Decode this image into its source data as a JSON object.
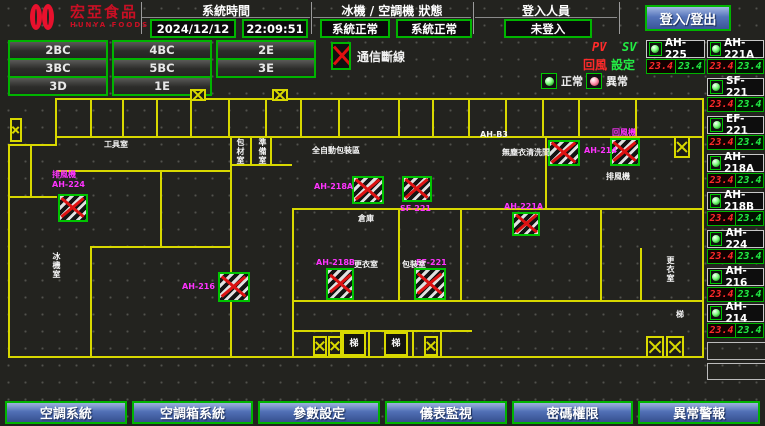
{
  "header": {
    "logo": {
      "line1": "宏亞食品",
      "line2": "HUNYA FOODS"
    },
    "system_time": {
      "label": "系統時間",
      "date": "2024/12/12",
      "time": "22:09:51"
    },
    "machine_status": {
      "label": "冰機 / 空調機 狀態",
      "chiller_status": "系統正常",
      "ahu_status": "系統正常"
    },
    "login": {
      "label": "登入人員",
      "value": "未登入",
      "button": "登入/登出"
    }
  },
  "floor_buttons": [
    {
      "label": "2BC",
      "x": 8,
      "y": 40
    },
    {
      "label": "4BC",
      "x": 112,
      "y": 40
    },
    {
      "label": "2E",
      "x": 216,
      "y": 40
    },
    {
      "label": "3BC",
      "x": 8,
      "y": 58
    },
    {
      "label": "5BC",
      "x": 112,
      "y": 58
    },
    {
      "label": "3E",
      "x": 216,
      "y": 58
    },
    {
      "label": "3D",
      "x": 8,
      "y": 76
    },
    {
      "label": "1E",
      "x": 112,
      "y": 76
    }
  ],
  "legend": {
    "comm_loss": "通信斷線",
    "normal": "正常",
    "abnormal": "異常",
    "pv": "PV",
    "sv": "SV",
    "pv_name": "回風",
    "sv_name": "設定"
  },
  "sidebar": {
    "units": [
      {
        "name": "AH-225",
        "pv": "23.4",
        "sv": "23.4",
        "x": 646,
        "y": 40,
        "w": 59
      },
      {
        "name": "AH-221A",
        "pv": "23.4",
        "sv": "23.4",
        "x": 707,
        "y": 40,
        "w": 57
      },
      {
        "name": "SF-221",
        "pv": "23.4",
        "sv": "23.4",
        "x": 707,
        "y": 78,
        "w": 57
      },
      {
        "name": "EF-221",
        "pv": "23.4",
        "sv": "23.4",
        "x": 707,
        "y": 116,
        "w": 57
      },
      {
        "name": "AH-218A",
        "pv": "23.4",
        "sv": "23.4",
        "x": 707,
        "y": 154,
        "w": 57
      },
      {
        "name": "AH-218B",
        "pv": "23.4",
        "sv": "23.4",
        "x": 707,
        "y": 192,
        "w": 57
      },
      {
        "name": "AH-224",
        "pv": "23.4",
        "sv": "23.4",
        "x": 707,
        "y": 230,
        "w": 57
      },
      {
        "name": "AH-216",
        "pv": "23.4",
        "sv": "23.4",
        "x": 707,
        "y": 268,
        "w": 57
      },
      {
        "name": "AH-214",
        "pv": "23.4",
        "sv": "23.4",
        "x": 707,
        "y": 304,
        "w": 57
      }
    ]
  },
  "floorplan": {
    "walls": [
      [
        55,
        98,
        649,
        2
      ],
      [
        55,
        98,
        2,
        48
      ],
      [
        8,
        144,
        49,
        2
      ],
      [
        8,
        144,
        2,
        214
      ],
      [
        8,
        356,
        696,
        2
      ],
      [
        702,
        98,
        2,
        260
      ],
      [
        55,
        136,
        649,
        2
      ],
      [
        90,
        98,
        2,
        40
      ],
      [
        122,
        98,
        2,
        40
      ],
      [
        156,
        98,
        2,
        40
      ],
      [
        190,
        98,
        2,
        40
      ],
      [
        228,
        98,
        2,
        40
      ],
      [
        265,
        98,
        2,
        40
      ],
      [
        300,
        98,
        2,
        40
      ],
      [
        338,
        98,
        2,
        40
      ],
      [
        398,
        98,
        2,
        40
      ],
      [
        432,
        98,
        2,
        40
      ],
      [
        468,
        98,
        2,
        40
      ],
      [
        505,
        98,
        2,
        40
      ],
      [
        542,
        98,
        2,
        40
      ],
      [
        578,
        98,
        2,
        40
      ],
      [
        635,
        98,
        2,
        40
      ],
      [
        230,
        136,
        2,
        222
      ],
      [
        250,
        136,
        2,
        28
      ],
      [
        270,
        136,
        2,
        28
      ],
      [
        230,
        164,
        62,
        2
      ],
      [
        57,
        170,
        175,
        2
      ],
      [
        30,
        144,
        2,
        54
      ],
      [
        8,
        196,
        49,
        2
      ],
      [
        160,
        170,
        2,
        78
      ],
      [
        90,
        246,
        142,
        2
      ],
      [
        90,
        248,
        2,
        108
      ],
      [
        292,
        208,
        412,
        2
      ],
      [
        292,
        210,
        2,
        146
      ],
      [
        398,
        208,
        2,
        94
      ],
      [
        460,
        208,
        2,
        94
      ],
      [
        292,
        300,
        412,
        2
      ],
      [
        545,
        136,
        2,
        74
      ],
      [
        600,
        210,
        2,
        92
      ],
      [
        640,
        248,
        2,
        54
      ],
      [
        292,
        330,
        180,
        2
      ],
      [
        340,
        332,
        2,
        24
      ],
      [
        368,
        332,
        2,
        24
      ],
      [
        412,
        332,
        2,
        24
      ],
      [
        440,
        332,
        2,
        24
      ]
    ],
    "units": [
      {
        "x": 58,
        "y": 194,
        "w": 30,
        "h": 28
      },
      {
        "x": 218,
        "y": 272,
        "w": 32,
        "h": 30
      },
      {
        "x": 352,
        "y": 176,
        "w": 32,
        "h": 28
      },
      {
        "x": 402,
        "y": 176,
        "w": 30,
        "h": 26
      },
      {
        "x": 326,
        "y": 268,
        "w": 28,
        "h": 32
      },
      {
        "x": 414,
        "y": 268,
        "w": 32,
        "h": 32
      },
      {
        "x": 548,
        "y": 140,
        "w": 32,
        "h": 26
      },
      {
        "x": 610,
        "y": 138,
        "w": 30,
        "h": 28
      },
      {
        "x": 512,
        "y": 212,
        "w": 28,
        "h": 24
      }
    ],
    "stairs": [
      {
        "x": 190,
        "y": 89,
        "w": 16,
        "h": 12
      },
      {
        "x": 272,
        "y": 89,
        "w": 16,
        "h": 12
      },
      {
        "x": 10,
        "y": 118,
        "w": 12,
        "h": 24
      },
      {
        "x": 313,
        "y": 336,
        "w": 14,
        "h": 20
      },
      {
        "x": 328,
        "y": 336,
        "w": 14,
        "h": 20
      },
      {
        "x": 424,
        "y": 336,
        "w": 14,
        "h": 20
      },
      {
        "x": 646,
        "y": 336,
        "w": 18,
        "h": 22
      },
      {
        "x": 666,
        "y": 336,
        "w": 18,
        "h": 22
      },
      {
        "x": 674,
        "y": 136,
        "w": 16,
        "h": 22
      }
    ],
    "labels": [
      {
        "text": "排風機",
        "x": 52,
        "y": 170,
        "c": "m"
      },
      {
        "text": "AH-224",
        "x": 52,
        "y": 180,
        "c": "m"
      },
      {
        "text": "AH-216",
        "x": 182,
        "y": 282,
        "c": "m"
      },
      {
        "text": "AH-218A",
        "x": 314,
        "y": 182,
        "c": "m"
      },
      {
        "text": "SF-221",
        "x": 400,
        "y": 204,
        "c": "m"
      },
      {
        "text": "AH-218B",
        "x": 316,
        "y": 258,
        "c": "m"
      },
      {
        "text": "EF-221",
        "x": 416,
        "y": 258,
        "c": "m"
      },
      {
        "text": "AH-214",
        "x": 584,
        "y": 146,
        "c": "m"
      },
      {
        "text": "回風機",
        "x": 612,
        "y": 128,
        "c": "m"
      },
      {
        "text": "AH-221A",
        "x": 504,
        "y": 202,
        "c": "m"
      },
      {
        "text": "工具室",
        "x": 104,
        "y": 140,
        "c": "w"
      },
      {
        "text": "全自動包裝區",
        "x": 312,
        "y": 146,
        "c": "w"
      },
      {
        "text": "AH-B3",
        "x": 480,
        "y": 130,
        "c": "w"
      },
      {
        "text": "無塵衣清洗間",
        "x": 502,
        "y": 148,
        "c": "w"
      },
      {
        "text": "更衣室",
        "x": 354,
        "y": 260,
        "c": "w"
      },
      {
        "text": "倉庫",
        "x": 358,
        "y": 214,
        "c": "w"
      },
      {
        "text": "包裝室",
        "x": 402,
        "y": 260,
        "c": "w"
      },
      {
        "text": "排風機",
        "x": 606,
        "y": 172,
        "c": "w"
      },
      {
        "text": "冰機室",
        "x": 52,
        "y": 252,
        "c": "w",
        "v": true
      },
      {
        "text": "更衣室",
        "x": 666,
        "y": 256,
        "c": "w",
        "v": true
      },
      {
        "text": "包材室",
        "x": 236,
        "y": 138,
        "c": "w",
        "v": true
      },
      {
        "text": "準備室",
        "x": 258,
        "y": 138,
        "c": "w",
        "v": true
      },
      {
        "text": "梯",
        "x": 342,
        "y": 332,
        "c": "w",
        "boxed": true
      },
      {
        "text": "梯",
        "x": 384,
        "y": 332,
        "c": "w",
        "boxed": true
      },
      {
        "text": "梯",
        "x": 676,
        "y": 310,
        "c": "w"
      }
    ]
  },
  "footer": {
    "buttons": [
      "空調系統",
      "空調箱系統",
      "參數設定",
      "儀表監視",
      "密碼權限",
      "異常警報"
    ]
  },
  "colors": {
    "accent_green": "#00b400",
    "wall_yellow": "#d8d800",
    "alarm_red": "#e01010",
    "label_magenta": "#ff33ff",
    "pv_red": "#ff2a2a",
    "sv_green": "#22ee44",
    "button_blue": "#4468b0",
    "logo_red": "#e8112d"
  }
}
